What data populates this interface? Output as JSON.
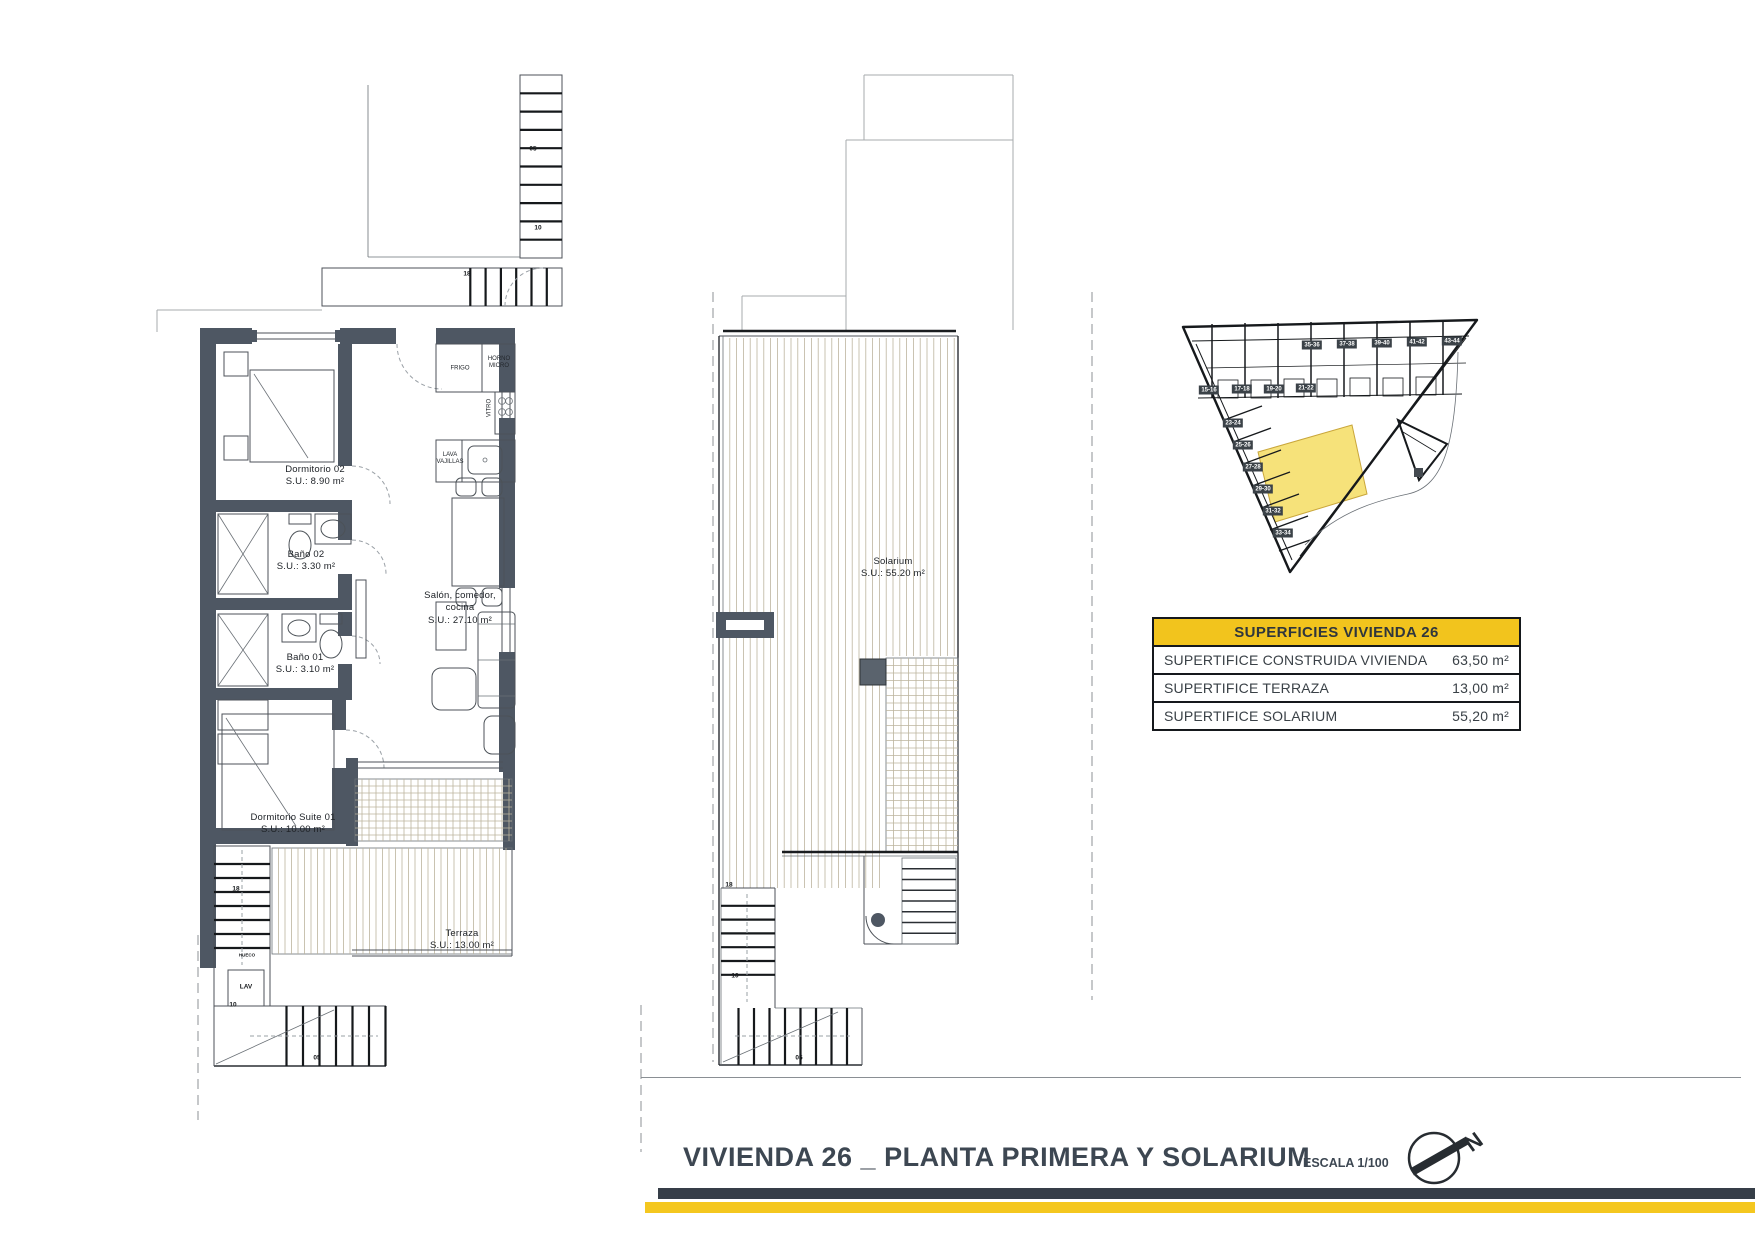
{
  "plan1": {
    "rooms": [
      {
        "name": "Dormitorio 02",
        "area": "S.U.: 8.90 m²"
      },
      {
        "name": "Baño 02",
        "area": "S.U.: 3.30 m²"
      },
      {
        "name": "Baño 01",
        "area": "S.U.: 3.10 m²"
      },
      {
        "name": "Salón, comedor,",
        "name2": "cocina",
        "area": "S.U.: 27.10 m²"
      },
      {
        "name": "Dormitorio Suite 01",
        "area": "S.U.: 10.00 m²"
      },
      {
        "name": "Terraza",
        "area": "S.U.: 13.00 m²"
      }
    ],
    "kitchen": {
      "frigo": "FRIGO",
      "horno": "HORNO",
      "micro": "MICRO",
      "vitro": "VITRO",
      "lava": "LAVA",
      "vajillas": "VAJILLAS"
    },
    "stairs": {
      "s05": "05",
      "s10": "10",
      "s18": "18",
      "well18": "18",
      "hueco": "HUECO",
      "lav": "LAV",
      "low10": "10",
      "bottom05": "05"
    }
  },
  "plan2": {
    "room": {
      "name": "Solarium",
      "area": "S.U.: 55.20 m²"
    },
    "stairs": {
      "top18": "18",
      "mid10": "10",
      "bottom05": "05"
    }
  },
  "siteplan": {
    "units_top": [
      "35-36",
      "37-38",
      "39-40",
      "41-42",
      "43-44"
    ],
    "units_mid": [
      "15-16",
      "17-18",
      "19-20",
      "21-22"
    ],
    "units_left": [
      "23-24",
      "25-26",
      "27-28",
      "29-30",
      "31-32",
      "33-34"
    ]
  },
  "table": {
    "title": "SUPERFICIES VIVIENDA 26",
    "rows": [
      {
        "label": "SUPERTIFICE CONSTRUIDA VIVIENDA",
        "value": "63,50 m²"
      },
      {
        "label": "SUPERTIFICE TERRAZA",
        "value": "13,00 m²"
      },
      {
        "label": "SUPERTIFICE SOLARIUM",
        "value": "55,20 m²"
      }
    ]
  },
  "footer": {
    "title": "VIVIENDA 26 _ PLANTA PRIMERA Y SOLARIUM",
    "scale": "ESCALA 1/100",
    "north": "N"
  },
  "colors": {
    "accent": "#F2C41D",
    "wall": "#4E5763",
    "ink": "#3D4752",
    "highlight": "#F6E27A"
  }
}
